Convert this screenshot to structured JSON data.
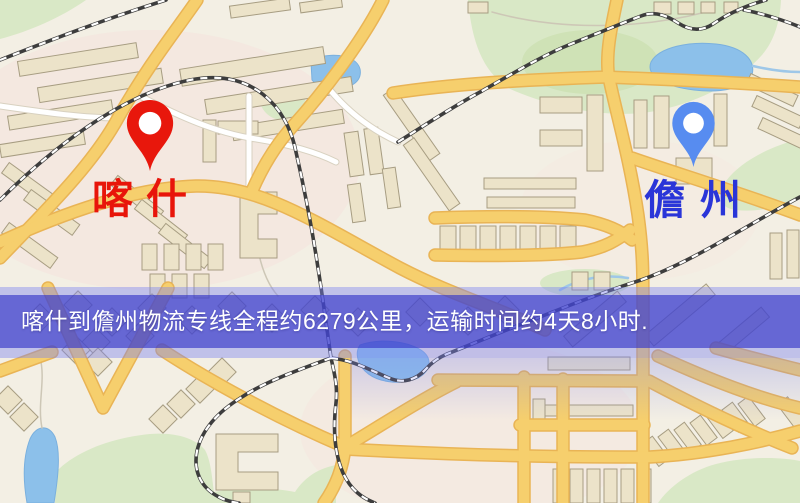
{
  "banner": {
    "text": "喀什到儋州物流专线全程约6279公里，运输时间约4天8小时.",
    "distance_km": "6279",
    "transit_time": "4天8小时",
    "background": "#3838c8",
    "text_color": "#ffffff"
  },
  "markers": {
    "origin": {
      "label": "喀什",
      "pin_color": "#e8170c",
      "label_color": "#e8150a"
    },
    "destination": {
      "label": "儋州",
      "pin_color": "#578cf0",
      "label_color": "#2a35d8"
    }
  },
  "map": {
    "palette": {
      "background": "#f3efe4",
      "road_major": "#f6cf6d",
      "road_minor": "#ffffff",
      "park": "#d9e8c6",
      "water": "#8cc0ea",
      "building": "#ece3c9",
      "railway": "#3d3d3d"
    }
  }
}
